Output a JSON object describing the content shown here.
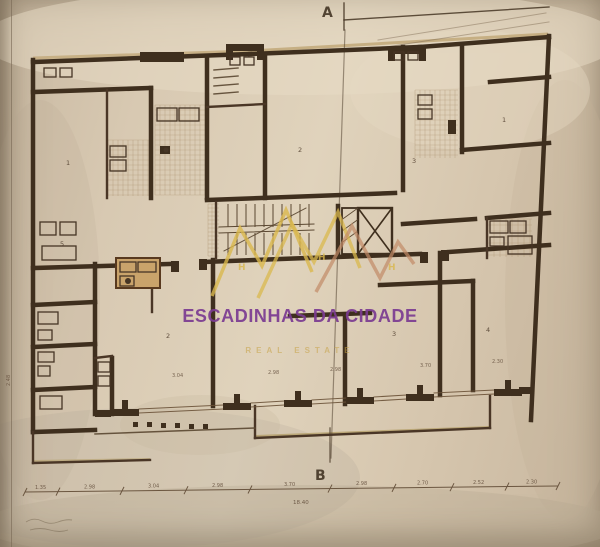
{
  "plan_labels": {
    "section_top": "A",
    "section_bottom": "B"
  },
  "watermark": {
    "title": "ESCADINHAS DA CIDADE",
    "subtitle": "REAL ESTATE",
    "title_color": "#7b3b92",
    "subtitle_color": "#c7a245",
    "logo_gold": "#d9b84e",
    "logo_salmon": "#c28a66",
    "logo_marks": [
      {
        "t": "H",
        "x": 238,
        "y": 270
      },
      {
        "t": "H",
        "x": 318,
        "y": 260
      },
      {
        "t": "H",
        "x": 388,
        "y": 270
      }
    ],
    "logo_polys": [
      {
        "pts": "212,296 240,228 262,266 286,210 312,272",
        "c": "#d9b84e",
        "w": 3.5,
        "o": 0.8
      },
      {
        "pts": "258,298 292,224 314,262 338,212 360,268",
        "c": "#d9b84e",
        "w": 3.5,
        "o": 0.75
      },
      {
        "pts": "316,292 352,226 380,278 398,242 414,264",
        "c": "#c28a66",
        "w": 3.5,
        "o": 0.7
      }
    ]
  },
  "colors": {
    "paper": "#d8c9b2",
    "wall": "#3f2f1e",
    "line": "#6b5238",
    "thin": "#5a4731",
    "tan": "#c4ab7d",
    "text": "#4a3828"
  },
  "plan": {
    "blotches": [
      [
        300,
        40,
        320,
        55,
        "#e8dcc6",
        0.5
      ],
      [
        140,
        478,
        220,
        70,
        "#8d8678",
        0.12
      ],
      [
        40,
        300,
        60,
        200,
        "#b9a98f",
        0.18
      ],
      [
        565,
        300,
        60,
        220,
        "#c2b098",
        0.28
      ],
      [
        300,
        525,
        320,
        40,
        "#b4a68e",
        0.3
      ],
      [
        470,
        90,
        120,
        60,
        "#e6d9c2",
        0.4
      ],
      [
        200,
        425,
        80,
        30,
        "#c7b79d",
        0.28
      ]
    ],
    "tan_lines": [
      [
        33,
        58,
        250,
        51,
        3,
        "#c4ab7d",
        0.85
      ],
      [
        250,
        51,
        548,
        34,
        3,
        "#c4ab7d",
        0.9
      ],
      [
        256,
        436,
        489,
        427,
        2,
        "#b5a06a",
        0.8
      ],
      [
        34,
        461,
        150,
        459,
        2,
        "#b5a06a",
        0.6
      ]
    ],
    "hatch_areas": [
      {
        "x": 155,
        "y": 105,
        "w": 50,
        "h": 90,
        "s": 5
      },
      {
        "x": 108,
        "y": 140,
        "w": 43,
        "h": 56,
        "s": 5
      },
      {
        "x": 415,
        "y": 90,
        "w": 43,
        "h": 68,
        "s": 5
      },
      {
        "x": 488,
        "y": 219,
        "w": 44,
        "h": 38,
        "s": 6
      },
      {
        "x": 208,
        "y": 204,
        "w": 11,
        "h": 52,
        "s": 4
      }
    ],
    "walls_thick": [
      [
        33,
        60,
        33,
        432
      ],
      [
        549,
        36,
        531,
        420
      ],
      [
        33,
        62,
        250,
        54
      ],
      [
        250,
        54,
        420,
        47
      ],
      [
        420,
        47,
        549,
        37
      ],
      [
        95,
        264,
        95,
        414
      ],
      [
        213,
        260,
        213,
        406
      ],
      [
        440,
        253,
        440,
        395
      ],
      [
        207,
        56,
        207,
        198
      ],
      [
        403,
        47,
        403,
        190
      ],
      [
        462,
        46,
        462,
        152
      ],
      [
        33,
        268,
        171,
        264
      ],
      [
        203,
        262,
        308,
        258
      ],
      [
        308,
        258,
        420,
        254
      ],
      [
        449,
        252,
        549,
        245
      ],
      [
        33,
        92,
        151,
        88
      ],
      [
        151,
        88,
        151,
        198
      ],
      [
        207,
        200,
        395,
        193
      ],
      [
        265,
        55,
        265,
        198
      ],
      [
        462,
        150,
        549,
        143
      ],
      [
        490,
        82,
        549,
        77
      ],
      [
        403,
        224,
        475,
        219
      ],
      [
        487,
        218,
        549,
        213
      ],
      [
        380,
        285,
        473,
        281
      ],
      [
        473,
        281,
        473,
        390
      ],
      [
        345,
        316,
        345,
        404
      ],
      [
        290,
        316,
        370,
        313
      ],
      [
        112,
        358,
        112,
        414
      ],
      [
        33,
        305,
        95,
        302
      ],
      [
        33,
        347,
        95,
        344
      ],
      [
        33,
        390,
        95,
        387
      ],
      [
        33,
        432,
        95,
        430
      ],
      [
        338,
        206,
        338,
        256
      ]
    ],
    "walls_medium": [
      [
        107,
        90,
        107,
        198
      ],
      [
        207,
        107,
        265,
        104
      ],
      [
        255,
        406,
        255,
        438
      ],
      [
        255,
        438,
        490,
        428
      ],
      [
        490,
        428,
        490,
        396
      ],
      [
        95,
        358,
        112,
        356
      ],
      [
        33,
        463,
        150,
        460
      ],
      [
        33,
        432,
        33,
        463
      ],
      [
        152,
        264,
        152,
        312
      ],
      [
        216,
        202,
        216,
        258
      ],
      [
        487,
        218,
        487,
        258
      ]
    ],
    "walls_thin": [
      [
        214,
        70,
        238,
        68
      ],
      [
        214,
        78,
        238,
        76
      ],
      [
        214,
        86,
        238,
        84
      ],
      [
        214,
        94,
        238,
        92
      ],
      [
        95,
        434,
        255,
        428
      ]
    ],
    "window_lines": [
      [
        139,
        409,
        223,
        405
      ],
      [
        139,
        413,
        223,
        409
      ],
      [
        251,
        403,
        284,
        401
      ],
      [
        251,
        407,
        284,
        405
      ],
      [
        312,
        400,
        346,
        398
      ],
      [
        312,
        404,
        346,
        402
      ],
      [
        374,
        397,
        406,
        395
      ],
      [
        374,
        401,
        406,
        399
      ],
      [
        434,
        393,
        494,
        390
      ],
      [
        434,
        397,
        494,
        394
      ]
    ],
    "dark_blocks": [
      [
        140,
        52,
        44,
        10
      ],
      [
        226,
        44,
        38,
        7
      ],
      [
        226,
        44,
        7,
        16
      ],
      [
        257,
        44,
        7,
        16
      ],
      [
        388,
        47,
        38,
        7
      ],
      [
        388,
        47,
        7,
        14
      ],
      [
        419,
        47,
        7,
        14
      ],
      [
        171,
        261,
        8,
        11
      ],
      [
        199,
        259,
        8,
        11
      ],
      [
        420,
        252,
        8,
        11
      ],
      [
        441,
        250,
        8,
        11
      ],
      [
        448,
        120,
        8,
        14
      ],
      [
        160,
        146,
        10,
        8
      ],
      [
        111,
        409,
        28,
        7
      ],
      [
        122,
        400,
        6,
        9
      ],
      [
        223,
        403,
        28,
        7
      ],
      [
        234,
        394,
        6,
        9
      ],
      [
        284,
        400,
        28,
        7
      ],
      [
        295,
        391,
        6,
        9
      ],
      [
        346,
        397,
        28,
        7
      ],
      [
        357,
        388,
        6,
        9
      ],
      [
        406,
        394,
        28,
        7
      ],
      [
        417,
        385,
        6,
        9
      ],
      [
        494,
        389,
        28,
        7
      ],
      [
        505,
        380,
        6,
        9
      ],
      [
        95,
        410,
        16,
        7
      ],
      [
        519,
        387,
        14,
        7
      ],
      [
        133,
        422,
        5,
        5
      ],
      [
        147,
        422,
        5,
        5
      ],
      [
        161,
        423,
        5,
        5
      ],
      [
        175,
        423,
        5,
        5
      ],
      [
        189,
        424,
        5,
        5
      ],
      [
        203,
        424,
        5,
        5
      ]
    ],
    "fixtures": [
      [
        44,
        68,
        12,
        9
      ],
      [
        60,
        68,
        12,
        9
      ],
      [
        40,
        222,
        16,
        13
      ],
      [
        60,
        222,
        16,
        13
      ],
      [
        42,
        246,
        34,
        14
      ],
      [
        38,
        312,
        20,
        12
      ],
      [
        38,
        330,
        14,
        10
      ],
      [
        38,
        352,
        16,
        10
      ],
      [
        38,
        366,
        12,
        10
      ],
      [
        40,
        396,
        22,
        13
      ],
      [
        157,
        108,
        20,
        13
      ],
      [
        179,
        108,
        20,
        13
      ],
      [
        110,
        146,
        16,
        11
      ],
      [
        110,
        160,
        16,
        11
      ],
      [
        230,
        57,
        10,
        8
      ],
      [
        244,
        57,
        10,
        8
      ],
      [
        394,
        52,
        10,
        8
      ],
      [
        408,
        52,
        10,
        8
      ],
      [
        418,
        95,
        14,
        10
      ],
      [
        418,
        109,
        14,
        10
      ],
      [
        490,
        221,
        18,
        12
      ],
      [
        510,
        221,
        16,
        12
      ],
      [
        490,
        237,
        14,
        9
      ],
      [
        508,
        236,
        24,
        18
      ],
      [
        98,
        362,
        12,
        10
      ],
      [
        98,
        376,
        12,
        10
      ],
      [
        120,
        262,
        16,
        10
      ],
      [
        138,
        262,
        18,
        10
      ],
      [
        120,
        276,
        14,
        10
      ]
    ],
    "kitchen_unit": {
      "x": 116,
      "y": 258,
      "w": 44,
      "h": 30,
      "fill": "#c9a36b",
      "stroke": "#58391f"
    },
    "circles": [
      [
        128,
        281,
        3
      ],
      [
        166,
        150,
        2.5
      ]
    ],
    "stair": {
      "x1": 219,
      "x2": 314,
      "ytop": 203,
      "ymid1": 227,
      "ymid2": 233,
      "ybot": 256,
      "step": 9,
      "diag": [
        224,
        251,
        306,
        208
      ]
    },
    "elevator": {
      "x": 358,
      "y": 208,
      "w": 34,
      "h": 46
    },
    "duct": {
      "x": 342,
      "y": 208,
      "w": 16,
      "h": 46
    },
    "a_lines": [
      [
        344,
        3,
        344,
        30
      ],
      [
        344,
        20,
        549,
        7
      ]
    ],
    "sketch_lines": [
      [
        378,
        40,
        546,
        13
      ],
      [
        386,
        47,
        549,
        22
      ]
    ],
    "section_line": [
      345,
      30,
      331,
      458
    ],
    "b_line": [
      330,
      428,
      330,
      462
    ],
    "room_labels": [
      {
        "t": "1",
        "x": 66,
        "y": 165
      },
      {
        "t": "2",
        "x": 298,
        "y": 152
      },
      {
        "t": "3",
        "x": 412,
        "y": 163
      },
      {
        "t": "1",
        "x": 502,
        "y": 122
      },
      {
        "t": "2",
        "x": 166,
        "y": 338
      },
      {
        "t": "3",
        "x": 392,
        "y": 336
      },
      {
        "t": "4",
        "x": 486,
        "y": 332
      },
      {
        "t": "5",
        "x": 60,
        "y": 246
      }
    ],
    "inner_dims": [
      {
        "t": "3.04",
        "x": 172,
        "y": 377
      },
      {
        "t": "2.98",
        "x": 268,
        "y": 374
      },
      {
        "t": "2.98",
        "x": 330,
        "y": 371
      },
      {
        "t": "3.70",
        "x": 420,
        "y": 367
      },
      {
        "t": "2.30",
        "x": 492,
        "y": 363
      },
      {
        "t": "2.48",
        "x": 10,
        "y": 386,
        "rot": -90
      }
    ],
    "dim_ticks": [
      25,
      58,
      122,
      186,
      250,
      330,
      394,
      452,
      507,
      558
    ],
    "dim_labels": [
      {
        "t": "1.35",
        "x": 41
      },
      {
        "t": "2.98",
        "x": 90
      },
      {
        "t": "3.04",
        "x": 154
      },
      {
        "t": "2.98",
        "x": 218
      },
      {
        "t": "3.70",
        "x": 290
      },
      {
        "t": "2.98",
        "x": 362
      },
      {
        "t": "2.70",
        "x": 423
      },
      {
        "t": "2.52",
        "x": 479
      },
      {
        "t": "2.30",
        "x": 532
      }
    ],
    "dim_total": {
      "t": "18.40",
      "x": 293,
      "y": 504
    },
    "scribbles": [
      "M26,522 q8,-5 16,-1 t16,1 t14,-2",
      "M30,530 q10,-3 20,0 t18,0"
    ]
  }
}
